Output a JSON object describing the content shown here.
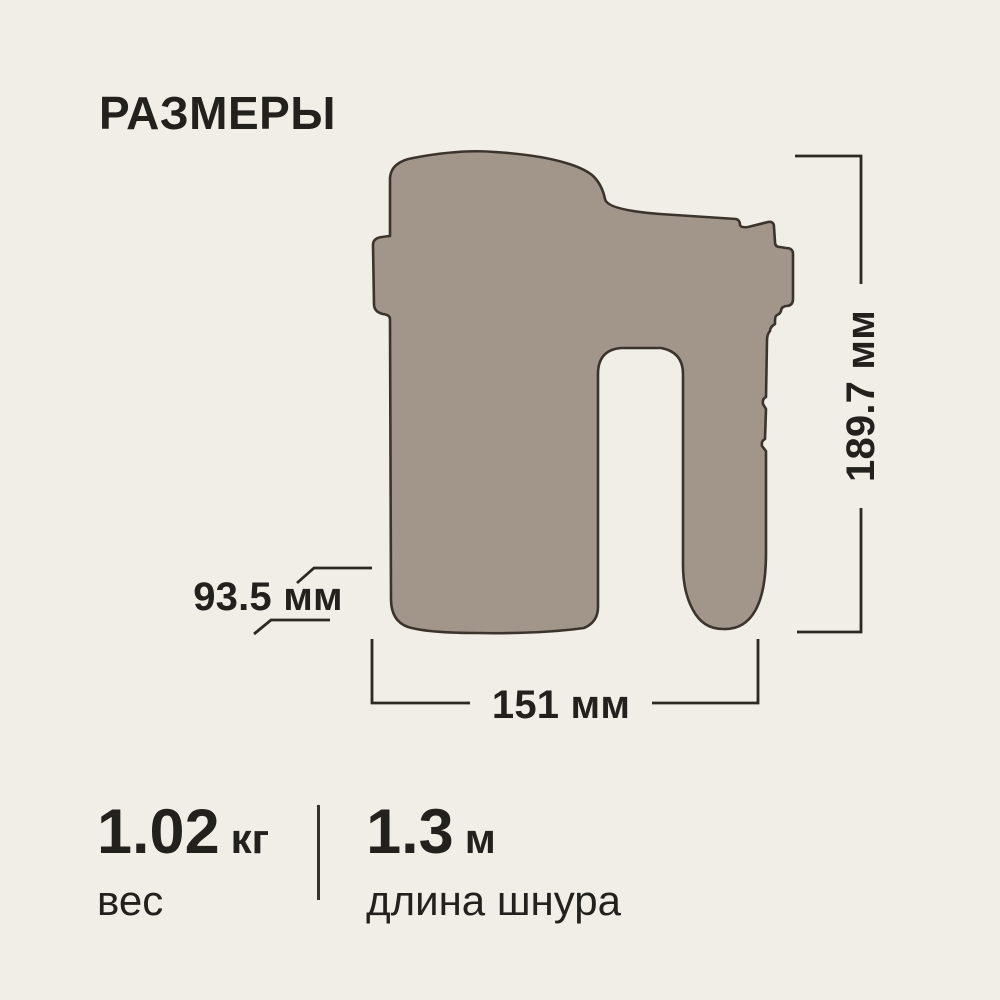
{
  "title": "РАЗМЕРЫ",
  "colors": {
    "background": "#f1eee7",
    "product_fill": "#a2968b",
    "product_outline": "#3b342d",
    "dimension_line": "#2b2923",
    "text": "#23211d"
  },
  "dimensions": {
    "height": {
      "label": "189.7 мм"
    },
    "width": {
      "label": "151 мм"
    },
    "depth": {
      "label": "93.5 мм"
    }
  },
  "stats": {
    "weight": {
      "value": "1.02",
      "unit": "кг",
      "caption": "вес"
    },
    "cord": {
      "value": "1.3",
      "unit": "м",
      "caption": "длина шнура"
    }
  }
}
